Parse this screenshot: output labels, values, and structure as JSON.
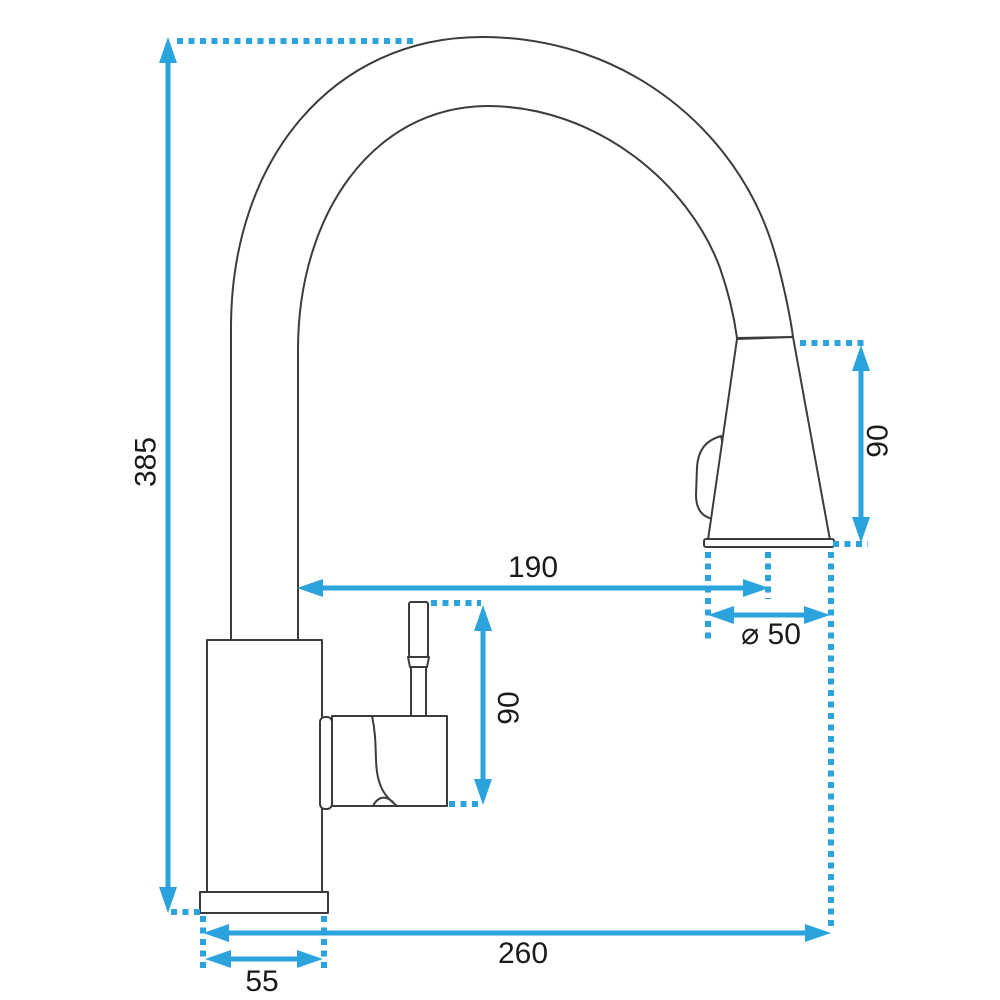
{
  "diagram": {
    "type": "technical-drawing",
    "subject": "Kitchen faucet with high arc spout and pull-down spray head, side view with dimension lines",
    "colors": {
      "dimension_accent": "#2ba3dc",
      "outline": "#3c3c3c",
      "label_text": "#1a1a1a",
      "background": "#ffffff"
    },
    "dimensions": {
      "total_height": "385",
      "spout_reach": "190",
      "spray_head_length": "90",
      "handle_height": "90",
      "spray_head_diameter": "⌀ 50",
      "base_reach": "260",
      "base_width": "55"
    }
  }
}
